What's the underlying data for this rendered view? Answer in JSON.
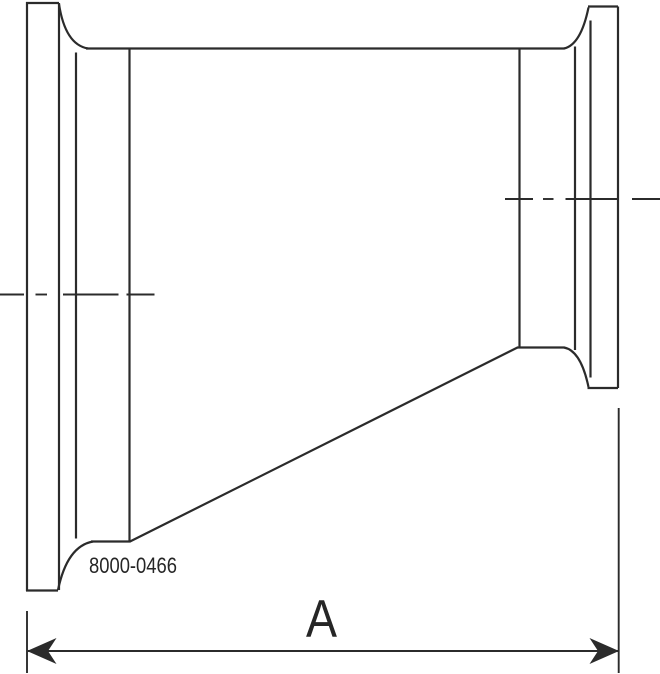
{
  "canvas": {
    "width": 660,
    "height": 674,
    "background": "#ffffff"
  },
  "style": {
    "stroke_color": "#2b2b2b",
    "text_color": "#262626"
  },
  "labels": {
    "part_number": "8000-0466",
    "dimension_a": "A"
  },
  "geometry": {
    "outline": [
      {
        "name": "left-flange-face",
        "d": "M 27 2 L 27 591"
      },
      {
        "name": "left-flange-top-edge",
        "d": "M 26 3 L 59 3"
      },
      {
        "name": "left-flange-bottom-edge",
        "d": "M 26 590.5 L 58 590.5"
      },
      {
        "name": "left-flange-back-face",
        "d": "M 59 3 L 59 590"
      },
      {
        "name": "left-top-neck-curve",
        "d": "M 59 4 C 62.5 27 70.5 45.5 88 48.5"
      },
      {
        "name": "left-bottom-neck-curve",
        "d": "M 58 590 C 63 566 73 545 93 541.5"
      },
      {
        "name": "body-top-line",
        "d": "M 86 48.5 L 564.5 48.5"
      },
      {
        "name": "large-end-bottom-line",
        "d": "M 91 541.5 L 130.5 541.5"
      },
      {
        "name": "left-tangent-line",
        "d": "M 76 52.5 L 76 538.5"
      },
      {
        "name": "left-weld-line",
        "d": "M 129.5 49 L 129.5 541"
      },
      {
        "name": "taper-line",
        "d": "M 130 541.5 L 517.5 347.5"
      },
      {
        "name": "small-end-bottom-line",
        "d": "M 517 347.5 L 564.5 347.5"
      },
      {
        "name": "right-weld-line",
        "d": "M 519.5 49 L 519.5 347"
      },
      {
        "name": "right-tangent-line",
        "d": "M 575 46.5 L 575 350"
      },
      {
        "name": "right-top-neck-curve",
        "d": "M 564 48.5 C 577.5 45.5 584.5 27 588.5 7.5"
      },
      {
        "name": "right-bottom-neck-curve",
        "d": "M 564 347.5 C 577.5 350 584.5 368 588.5 387"
      },
      {
        "name": "right-flange-top-edge",
        "d": "M 588 6.5 L 618 6.5"
      },
      {
        "name": "right-flange-bottom-edge",
        "d": "M 587.5 388 L 618 388"
      },
      {
        "name": "right-flange-back-face",
        "d": "M 590.5 20.5 L 590.5 377.5"
      },
      {
        "name": "right-flange-face",
        "d": "M 618 6.5 L 618 388"
      }
    ],
    "centerlines": [
      {
        "name": "large-end-centerline-seg-1",
        "d": "M 0 294.5 L 24 294.5"
      },
      {
        "name": "large-end-centerline-seg-2",
        "d": "M 35.5 294.5 L 47 294.5"
      },
      {
        "name": "large-end-centerline-seg-3",
        "d": "M 63 294.5 L 118.5 294.5"
      },
      {
        "name": "large-end-centerline-seg-4",
        "d": "M 126.5 294.5 L 154.5 294.5"
      },
      {
        "name": "small-end-centerline-seg-1",
        "d": "M 505 199 L 533 199"
      },
      {
        "name": "small-end-centerline-seg-2",
        "d": "M 543 199 L 553.5 199"
      },
      {
        "name": "small-end-centerline-seg-3",
        "d": "M 565.5 199 L 618.5 199"
      },
      {
        "name": "small-end-centerline-seg-4",
        "d": "M 632 199 L 660 199"
      }
    ],
    "dimension": {
      "lines": [
        {
          "name": "left-extension-line",
          "d": "M 27 611 L 27 673"
        },
        {
          "name": "right-extension-line",
          "d": "M 618.7 408 L 618.7 673"
        },
        {
          "name": "dimension-line",
          "d": "M 28 651 L 618 651"
        }
      ],
      "arrowheads": [
        {
          "name": "left-arrowhead-icon",
          "points": "27,651 56.5,638 48,651 56.5,664"
        },
        {
          "name": "right-arrowhead-icon",
          "points": "619,651 589.5,638 598,651 589.5,664"
        }
      ]
    }
  }
}
